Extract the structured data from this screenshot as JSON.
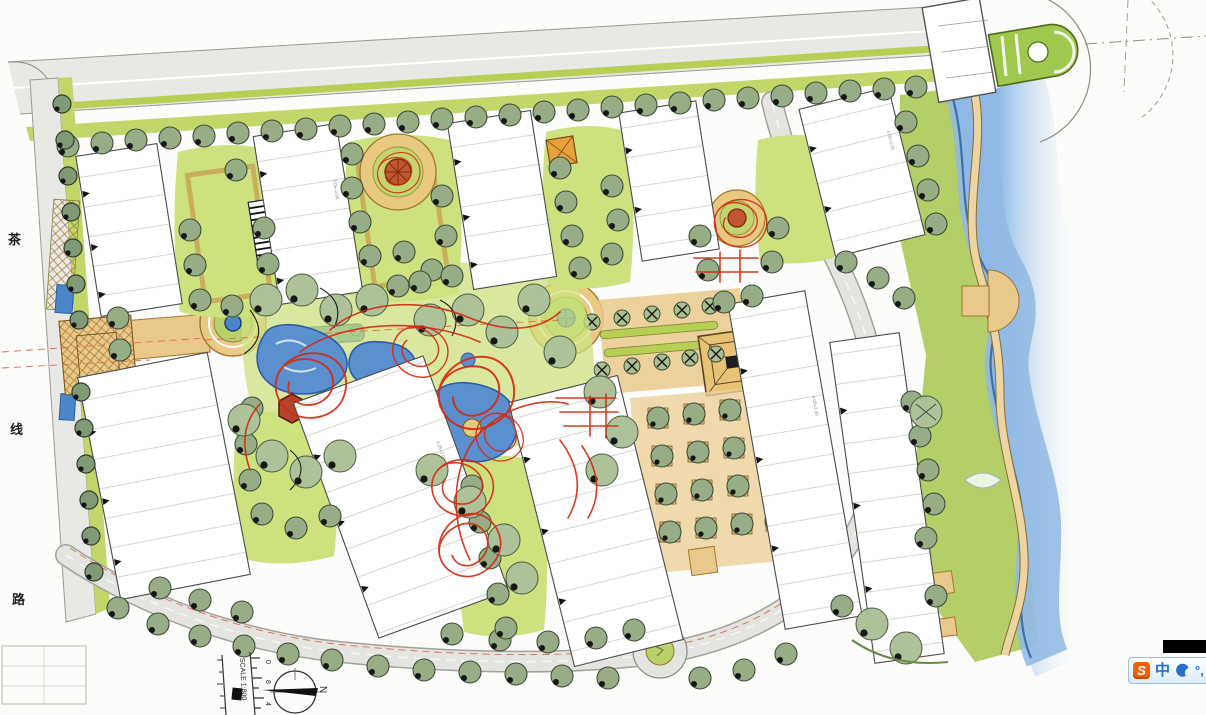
{
  "street_label": {
    "chars": [
      "茶",
      "线",
      "路"
    ]
  },
  "scale": {
    "label": "SCALE 1:800",
    "ticks": [
      "0",
      "8",
      "4"
    ]
  },
  "compass": {
    "north_label": "N"
  },
  "annotations": {
    "elevation": "4.05+2.00"
  },
  "ime": {
    "logo": "S",
    "mode": "中",
    "punct": "°,"
  }
}
